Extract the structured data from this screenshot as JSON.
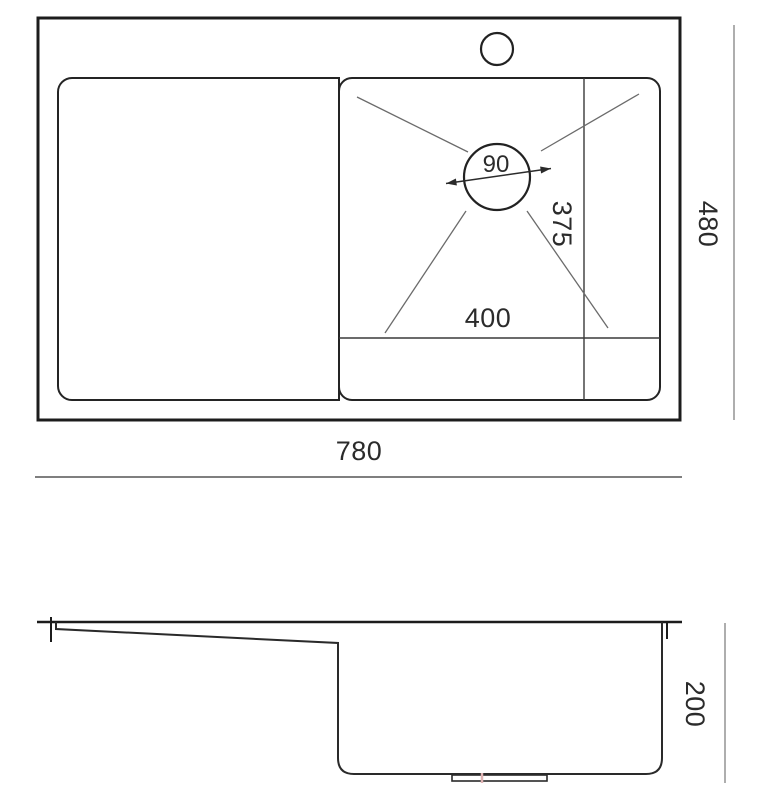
{
  "drawing": {
    "title": "sink-dimension-drawing",
    "dimensions": {
      "drain_diameter": "90",
      "drain_offset_vertical": "375",
      "drain_offset_horizontal": "400",
      "overall_depth": "480",
      "overall_width": "780",
      "bowl_height": "200"
    },
    "colors": {
      "outline_dark": "#1c1c1c",
      "inner_line": "#2e2e2e",
      "helper_line": "#6b6b6b",
      "dim_line_gray": "#999999",
      "dim_line_dark": "#555555",
      "accent_pink": "#dfb3b3",
      "background": "#ffffff"
    }
  }
}
